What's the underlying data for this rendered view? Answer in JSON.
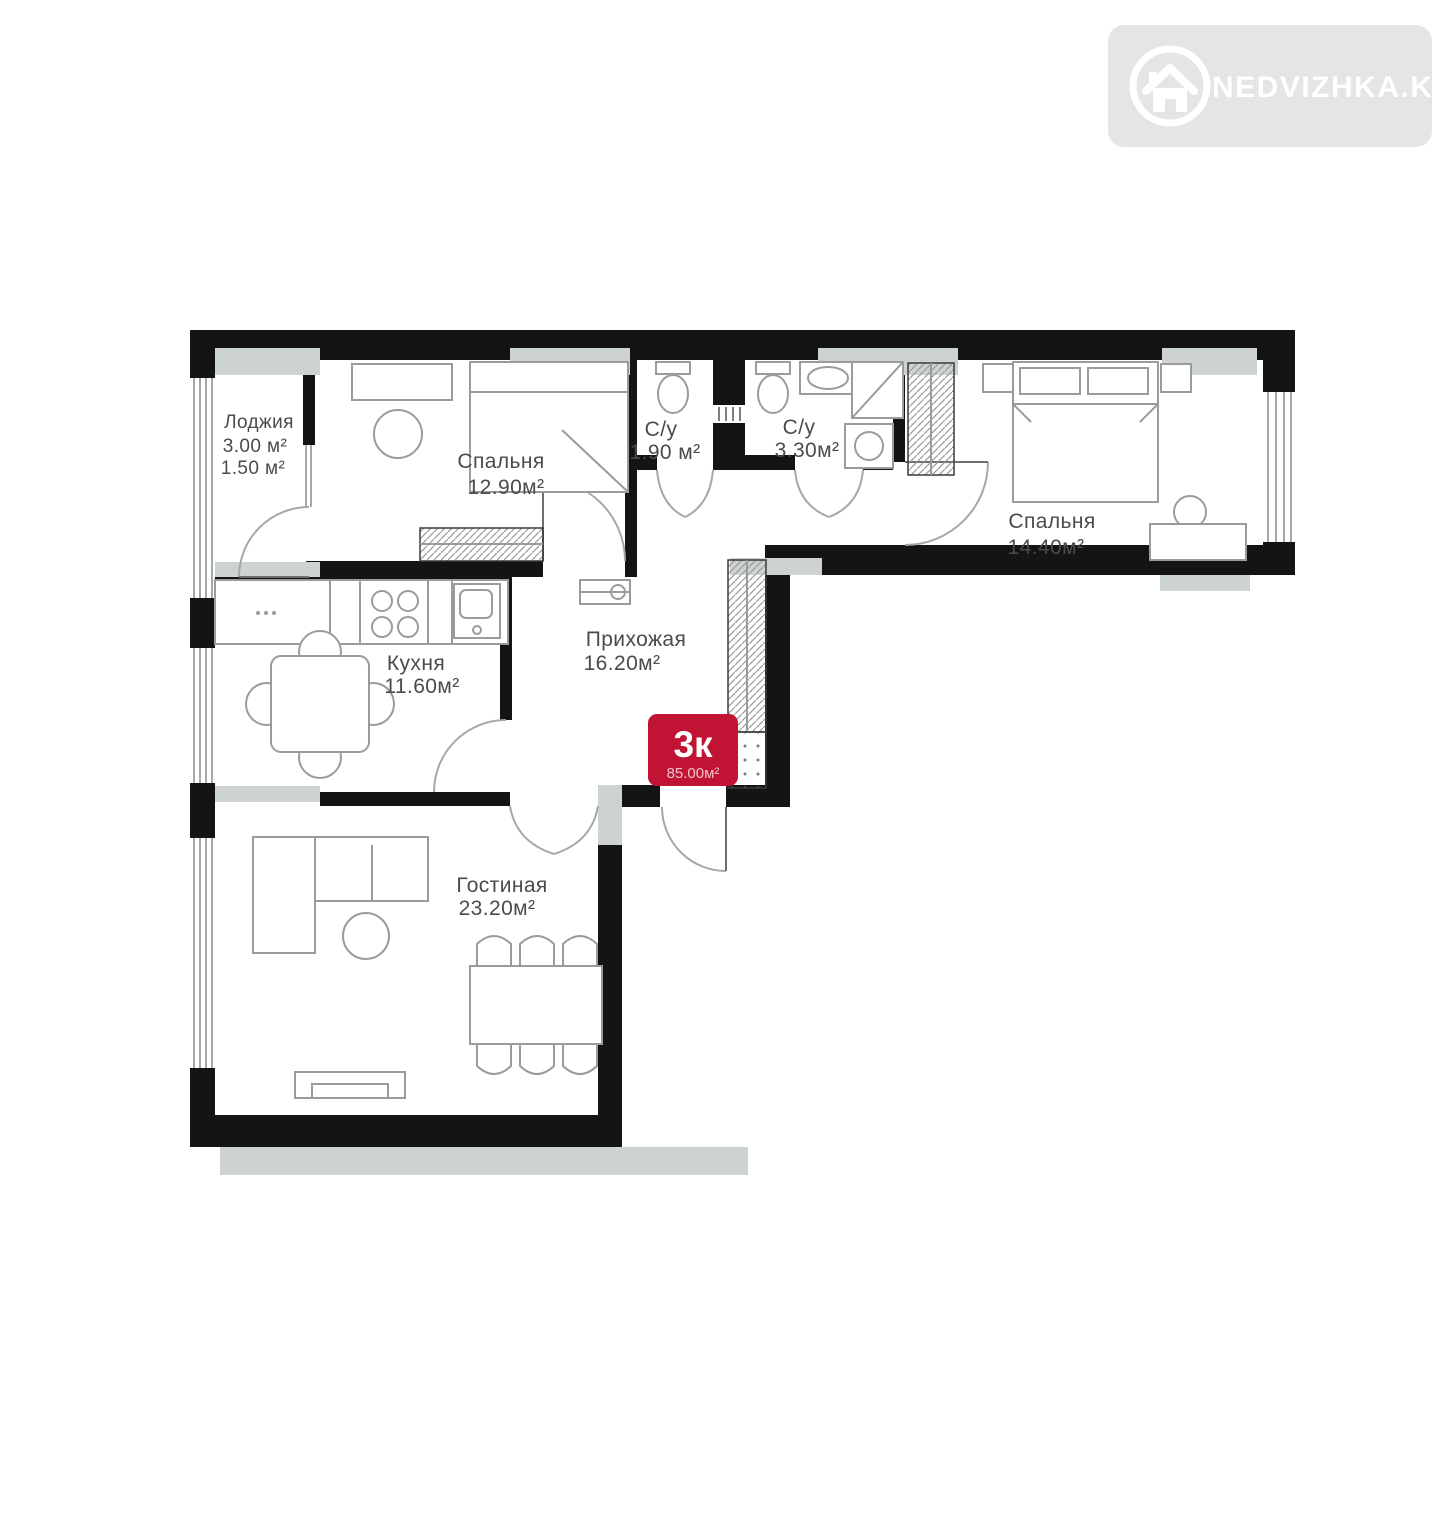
{
  "watermark": {
    "brand": "NEDVIZHKA.KZ",
    "icon": "house-icon",
    "bg_color": "#e4e5e4",
    "text_color": "#ffffff"
  },
  "floor_plan": {
    "type_badge": {
      "label": "3к",
      "area": "85.00м²",
      "bg_color": "#c11434",
      "text_color": "#ffffff"
    },
    "rooms": [
      {
        "id": "loggia",
        "name": "Лоджия",
        "area": "3.00 м²",
        "area2": "1.50 м²"
      },
      {
        "id": "bedroom-1",
        "name": "Спальня",
        "area": "12.90м²"
      },
      {
        "id": "bathroom-1",
        "name": "С/у",
        "area": "1.90 м²"
      },
      {
        "id": "bathroom-2",
        "name": "С/у",
        "area": "3.30м²"
      },
      {
        "id": "bedroom-2",
        "name": "Спальня",
        "area": "14.40м²"
      },
      {
        "id": "kitchen",
        "name": "Кухня",
        "area": "11.60м²"
      },
      {
        "id": "hallway",
        "name": "Прихожая",
        "area": "16.20м²"
      },
      {
        "id": "living-room",
        "name": "Гостиная",
        "area": "23.20м²"
      }
    ],
    "colors": {
      "walls": "#141414",
      "windows": "#cdd3cf",
      "furniture": "#9b9b9b",
      "labels": "#4b4b4b"
    }
  }
}
